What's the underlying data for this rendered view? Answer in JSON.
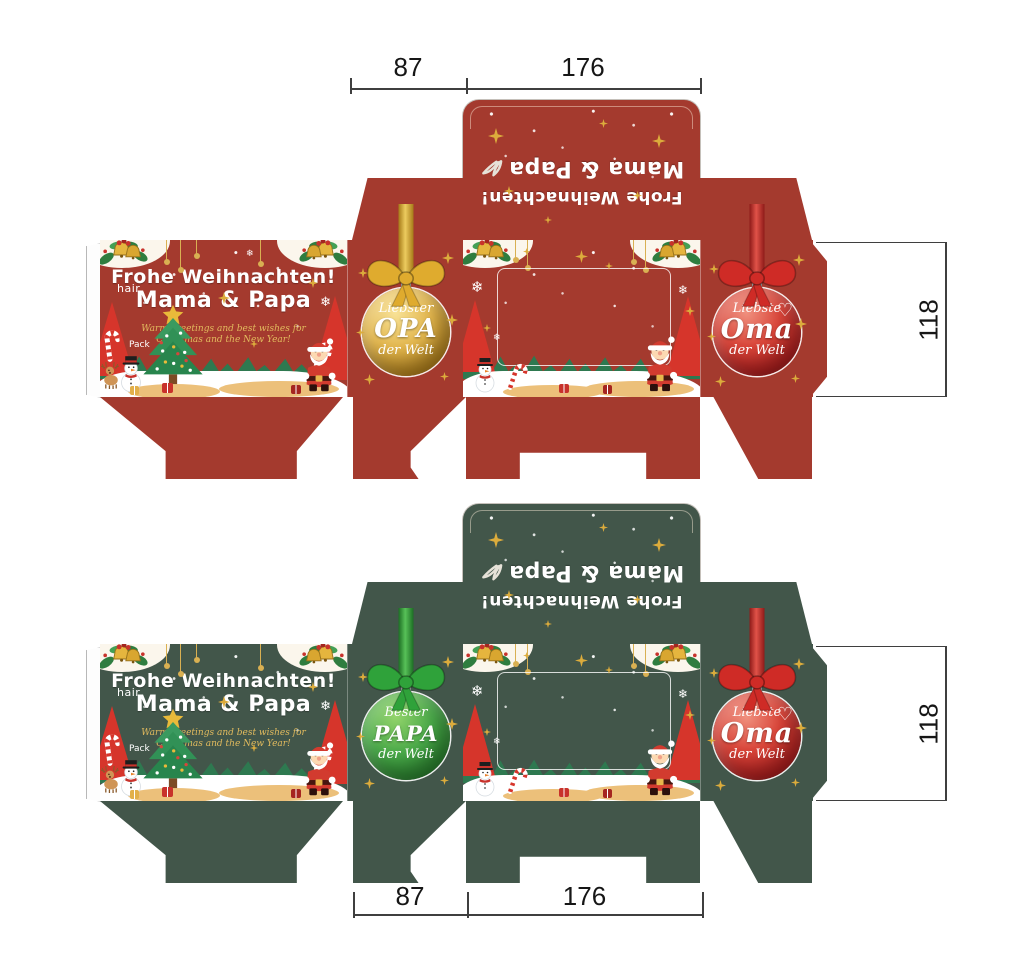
{
  "page": {
    "background": "#ffffff",
    "subject": "Christmas gift box packaging dieline, red and green variants, with measurements"
  },
  "dimensions": {
    "side_width_label": "87",
    "front_width_label": "176",
    "height_label": "118"
  },
  "shared": {
    "lid_line1": "Frohe Weihnachten!",
    "lid_line2": "Mama & Papa",
    "front": {
      "brand": "hair",
      "pack": "Pack",
      "title1": "Frohe Weihnachten!",
      "title2": "Mama & Papa",
      "sub1": "Warm greetings and best wishes for",
      "sub2": "Christmas and the New Year!"
    },
    "oma": {
      "w1": "Liebste",
      "w2": "Oma",
      "w3": "der Welt",
      "heart": "♡"
    }
  },
  "boxes": {
    "red": {
      "base_color": "#a43a2e",
      "left_ornament": {
        "w1": "Liebster",
        "w2": "OPA",
        "w3": "der Welt",
        "ball_color": "#c79a2a"
      }
    },
    "green": {
      "base_color": "#42564a",
      "left_ornament": {
        "w1": "Bester",
        "w2": "PAPA",
        "w3": "der Welt",
        "ball_color": "#2f9e3c"
      }
    }
  },
  "palette": {
    "gold": "#dcac3c",
    "bright_red": "#d6352b",
    "scene_green": "#2e7950",
    "sand": "#ecc07a"
  }
}
